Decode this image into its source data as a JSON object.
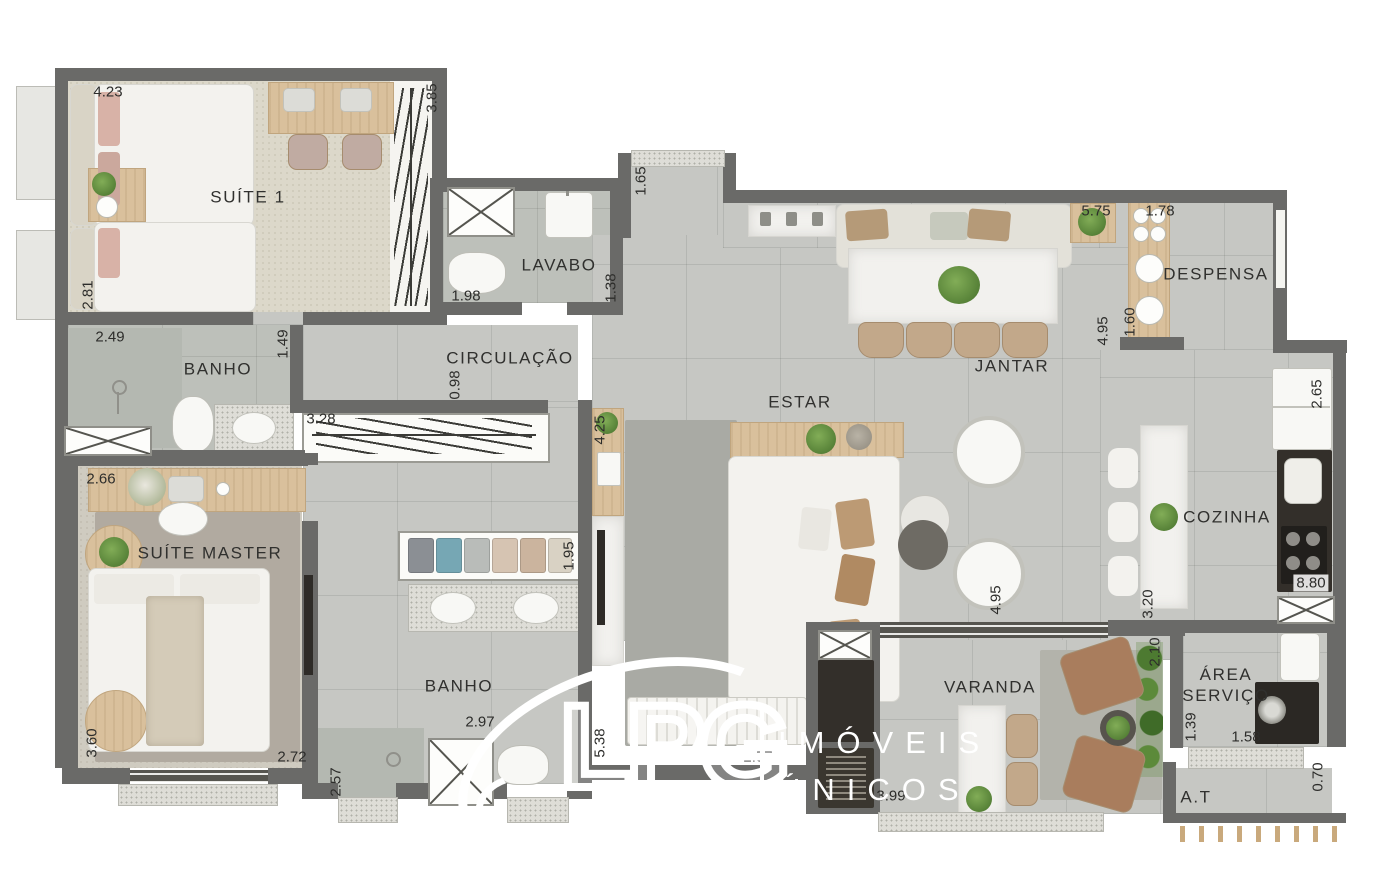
{
  "watermark": {
    "logo": "LPG",
    "tagline": [
      "IMÓVEIS",
      "ÚNICOS"
    ]
  },
  "palette": {
    "wall": "#6a6a68",
    "floor": "#c6c7c3",
    "bath_floor": "#bdc0ba",
    "carpet": "#dcd8ca",
    "master_rug": "#b1aaa0",
    "estar_rug": "#a9aaa4",
    "wood": "#d9c09c",
    "marble": "#f2f1ee",
    "dark_counter": "#332f2a",
    "tan_upholstery": "#bc9f80",
    "plant_green": "#5f8f3e"
  },
  "room_labels": [
    {
      "text": "SUÍTE 1",
      "x": 248,
      "y": 197,
      "rot": 0
    },
    {
      "text": "LAVABO",
      "x": 559,
      "y": 265,
      "rot": 0
    },
    {
      "text": "CIRCULAÇÃO",
      "x": 510,
      "y": 358,
      "rot": 0
    },
    {
      "text": "BANHO",
      "x": 218,
      "y": 369,
      "rot": 0
    },
    {
      "text": "SUÍTE MASTER",
      "x": 210,
      "y": 553,
      "rot": 0
    },
    {
      "text": "BANHO",
      "x": 459,
      "y": 686,
      "rot": 0
    },
    {
      "text": "ESTAR",
      "x": 800,
      "y": 402,
      "rot": 0
    },
    {
      "text": "JANTAR",
      "x": 1012,
      "y": 366,
      "rot": 0
    },
    {
      "text": "DESPENSA",
      "x": 1216,
      "y": 274,
      "rot": 0
    },
    {
      "text": "COZINHA",
      "x": 1227,
      "y": 517,
      "rot": 0
    },
    {
      "text": "VARANDA",
      "x": 990,
      "y": 687,
      "rot": 0
    },
    {
      "text": "ÁREA\nSERVIÇO",
      "x": 1226,
      "y": 685,
      "rot": 0
    },
    {
      "text": "A.T",
      "x": 1196,
      "y": 797,
      "rot": 0
    }
  ],
  "dim_labels": [
    {
      "text": "4.23",
      "x": 108,
      "y": 92,
      "rot": 0
    },
    {
      "text": "3.85",
      "x": 432,
      "y": 98,
      "rot": -90
    },
    {
      "text": "2.81",
      "x": 88,
      "y": 295,
      "rot": -90
    },
    {
      "text": "2.49",
      "x": 110,
      "y": 337,
      "rot": 0
    },
    {
      "text": "1.49",
      "x": 283,
      "y": 344,
      "rot": -90
    },
    {
      "text": "1.98",
      "x": 466,
      "y": 296,
      "rot": 0
    },
    {
      "text": "1.38",
      "x": 611,
      "y": 288,
      "rot": -90
    },
    {
      "text": "1.65",
      "x": 641,
      "y": 181,
      "rot": -90
    },
    {
      "text": "0.98",
      "x": 455,
      "y": 385,
      "rot": -90
    },
    {
      "text": "3.28",
      "x": 321,
      "y": 419,
      "rot": 0
    },
    {
      "text": "4.25",
      "x": 600,
      "y": 430,
      "rot": -90
    },
    {
      "text": "2.66",
      "x": 101,
      "y": 479,
      "rot": 0
    },
    {
      "text": "1.95",
      "x": 569,
      "y": 556,
      "rot": -90
    },
    {
      "text": "3.60",
      "x": 92,
      "y": 743,
      "rot": -90
    },
    {
      "text": "2.72",
      "x": 292,
      "y": 757,
      "rot": 0
    },
    {
      "text": "2.57",
      "x": 336,
      "y": 782,
      "rot": -90
    },
    {
      "text": "2.97",
      "x": 480,
      "y": 722,
      "rot": 0
    },
    {
      "text": "5.38",
      "x": 600,
      "y": 743,
      "rot": -90
    },
    {
      "text": "2.57",
      "x": 758,
      "y": 757,
      "rot": 0
    },
    {
      "text": "5.75",
      "x": 1096,
      "y": 211,
      "rot": 0
    },
    {
      "text": "4.95",
      "x": 1103,
      "y": 331,
      "rot": -90
    },
    {
      "text": "1.78",
      "x": 1160,
      "y": 211,
      "rot": 0
    },
    {
      "text": "1.60",
      "x": 1130,
      "y": 322,
      "rot": -90
    },
    {
      "text": "2.65",
      "x": 1317,
      "y": 394,
      "rot": -90
    },
    {
      "text": "4.95",
      "x": 996,
      "y": 600,
      "rot": -90
    },
    {
      "text": "3.20",
      "x": 1148,
      "y": 604,
      "rot": -90
    },
    {
      "text": "8.80",
      "x": 1311,
      "y": 583,
      "rot": 0,
      "bg": true
    },
    {
      "text": "2.10",
      "x": 1155,
      "y": 652,
      "rot": -90
    },
    {
      "text": "3.99",
      "x": 891,
      "y": 796,
      "rot": 0
    },
    {
      "text": "1.39",
      "x": 1191,
      "y": 727,
      "rot": -90
    },
    {
      "text": "1.58",
      "x": 1246,
      "y": 737,
      "rot": 0
    },
    {
      "text": "0.70",
      "x": 1318,
      "y": 777,
      "rot": -90
    }
  ]
}
